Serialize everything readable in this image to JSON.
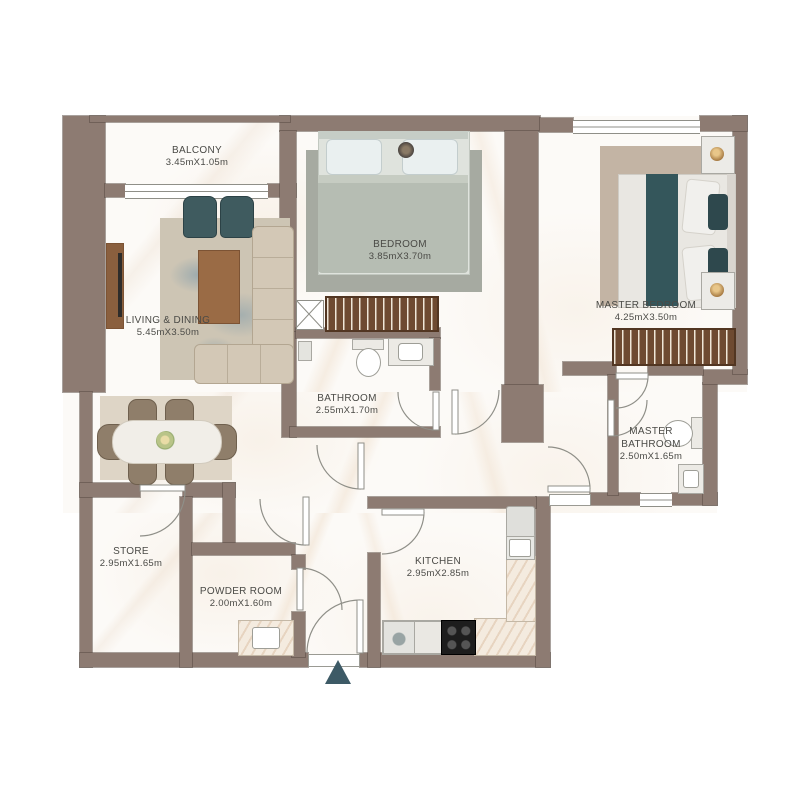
{
  "plan_title": "2 bedroom apartment floor plan",
  "rooms": [
    {
      "id": "balcony",
      "name": "BALCONY",
      "dimensions": "3.45mX1.05m"
    },
    {
      "id": "living_dining",
      "name": "LIVING & DINING",
      "dimensions": "5.45mX3.50m"
    },
    {
      "id": "bedroom",
      "name": "BEDROOM",
      "dimensions": "3.85mX3.70m"
    },
    {
      "id": "master_bedroom",
      "name": "MASTER BEDROOM",
      "dimensions": "4.25mX3.50m"
    },
    {
      "id": "bathroom",
      "name": "BATHROOM",
      "dimensions": "2.55mX1.70m"
    },
    {
      "id": "master_bathroom",
      "name": "MASTER BATHROOM",
      "dimensions": "2.50mX1.65m"
    },
    {
      "id": "store",
      "name": "STORE",
      "dimensions": "2.95mX1.65m"
    },
    {
      "id": "powder_room",
      "name": "POWDER ROOM",
      "dimensions": "2.00mX1.60m"
    },
    {
      "id": "kitchen",
      "name": "KITCHEN",
      "dimensions": "2.95mX2.85m"
    }
  ],
  "icons": {
    "entrance_marker": "triangle-up"
  },
  "palette": {
    "wall": "#8d7b72",
    "floor": "#fcfaf7",
    "accent_teal": "#3f5b5f",
    "wood": "#9a6b45",
    "wardrobe": "#6e4a31",
    "entrance_marker": "#3d5a66",
    "label_text": "#4a4a46"
  }
}
